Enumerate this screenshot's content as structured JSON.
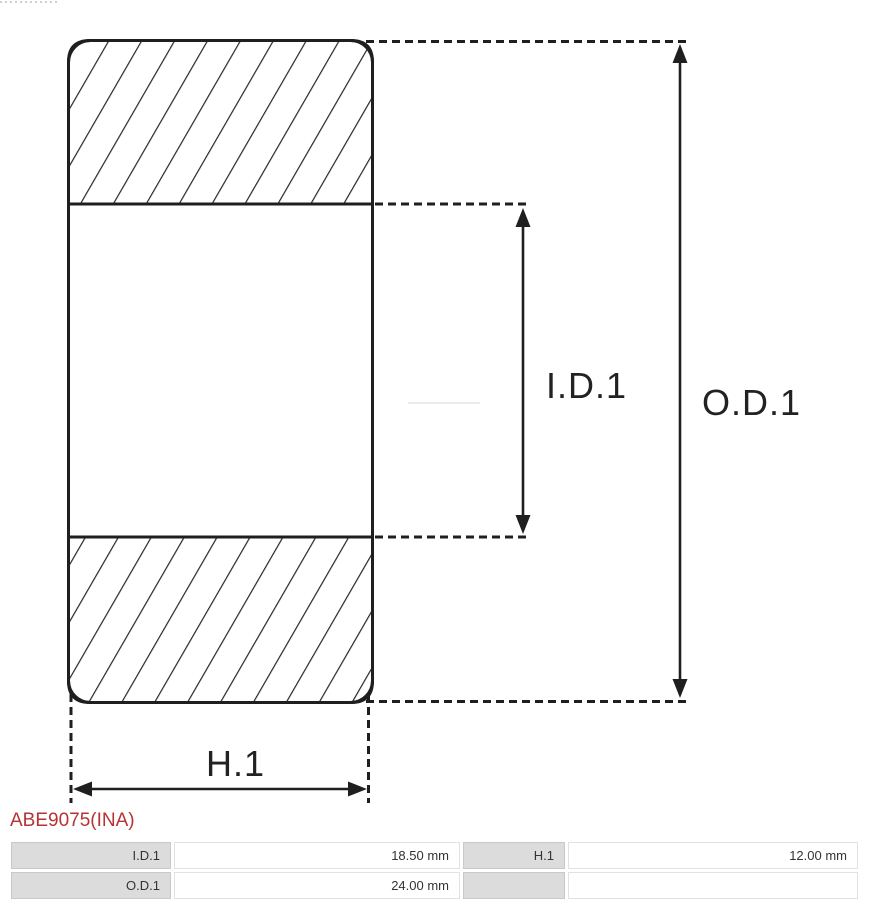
{
  "colors": {
    "accent-red": "#b73333",
    "diagram-line": "#1f1f1f",
    "table-label-bg": "#dcdcdc",
    "table-label-border": "#c9c9c9",
    "table-value-border": "#e2e2e2",
    "table-text": "#333333"
  },
  "diagram": {
    "type": "bearing-cross-section",
    "dimension_labels": {
      "inner_diameter": "I.D.1",
      "outer_diameter": "O.D.1",
      "height": "H.1"
    }
  },
  "part_number": {
    "text": "ABE9075(INA)"
  },
  "spec_table": {
    "rows": [
      {
        "cells": [
          {
            "label": "I.D.1",
            "value": "18.50 mm"
          },
          {
            "label": "H.1",
            "value": "12.00 mm"
          }
        ]
      },
      {
        "cells": [
          {
            "label": "O.D.1",
            "value": "24.00 mm"
          },
          {
            "label": "",
            "value": ""
          }
        ]
      }
    ]
  }
}
